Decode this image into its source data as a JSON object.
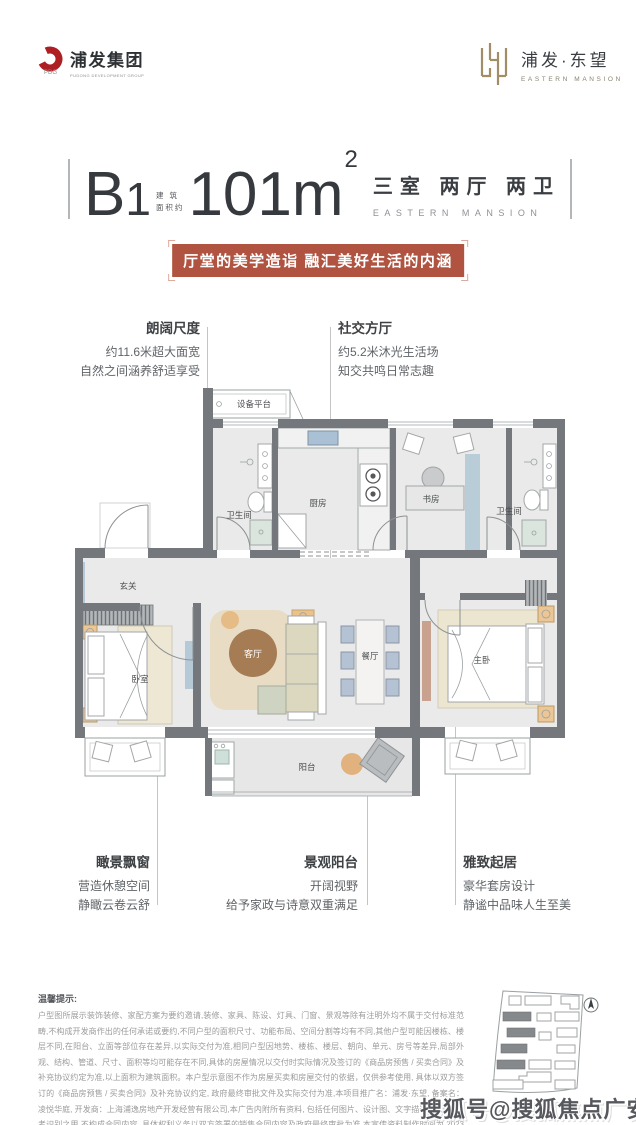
{
  "header": {
    "left_logo": {
      "name": "浦发集团",
      "subtitle": "PUDONG DEVELOPMENT GROUP"
    },
    "right_logo": {
      "name": "浦发·东望",
      "subtitle": "EASTERN MANSION"
    }
  },
  "title": {
    "unit_b": "B",
    "unit_1": "1",
    "area_note_line1": "建 筑",
    "area_note_line2": "面积约",
    "area": "101m",
    "area_sup": "2",
    "rooms": "三室 两厅 两卫",
    "rooms_sub": "EASTERN MANSION"
  },
  "banner": {
    "text": "厅堂的美学造诣 融汇美好生活的内涵"
  },
  "callouts": {
    "top_left": {
      "title": "朗阔尺度",
      "lines": [
        "约11.6米超大面宽",
        "自然之间涵养舒适享受"
      ]
    },
    "top_right": {
      "title": "社交方厅",
      "lines": [
        "约5.2米沐光生活场",
        "知交共鸣日常志趣"
      ]
    },
    "bottom_left": {
      "title": "瞰景飘窗",
      "lines": [
        "营造休憩空间",
        "静瞰云卷云舒"
      ]
    },
    "bottom_center": {
      "title": "景观阳台",
      "lines": [
        "开阔视野",
        "给予家政与诗意双重满足"
      ]
    },
    "bottom_right": {
      "title": "雅致起居",
      "lines": [
        "豪华套房设计",
        "静谧中品味人生至美"
      ]
    }
  },
  "floorplan": {
    "rooms": {
      "equipment": "设备平台",
      "bath1": "卫生间",
      "kitchen": "厨房",
      "study": "书房",
      "bath2": "卫生间",
      "foyer": "玄关",
      "bedroom": "卧室",
      "living": "客厅",
      "dining": "餐厅",
      "master": "主卧",
      "balcony": "阳台"
    }
  },
  "disclaimer": {
    "label": "温馨提示:",
    "text": "户型图所展示装饰装修、家配方案为要约邀请,装修、家具、陈设、灯具、门窗、景观等除有注明外均不属于交付标准范畴,不构成开发商作出的任何承诺或要约,不同户型的面积尺寸、功能布局、空间分割等均有不同,其他户型可能因楼栋、楼层不同,在阳台、立面等部位存在差异,以实际交付为准,相同户型因地势、楼栋、楼层、朝向、单元、房号等差异,局部外观、结构、管道、尺寸、面积等均可能存在不同,具体的房屋情况以交付时实际情况及签订的《商品房预售 / 买卖合同》及补充协议约定为准,以上面积为建筑面积。本户型示意图不作为房屋买卖和房屋交付的依据，仅供参考使用, 具体以双方签订的《商品房预售 / 买卖合同》及补充协议约定, 政府最终审批文件及实际交付为准,本项目推广名：浦发·东望, 备案名：凌悦华庭, 开发商：上海浦逸房地产开发经营有限公司,本广告内附所有资料, 包括任何图片、设计图、文字描述等, 仅供参考识别之用,不构成合同内容, 具体权利义务以双方签署的销售合同内容及政府最终审批为准,本宣传资料制作时间为 2023 年 08 月, 本公司保留对其进行变更或更改的权利, 如有更新, 恕不另行通知, 请以最终资料为准。"
  },
  "watermark": "搜狐号@搜狐焦点广安站",
  "colors": {
    "accent_red": "#b05340",
    "logo_red": "#ae1f24",
    "gold": "#a38d66",
    "wall_gray": "#74777b",
    "floor_gray": "#e9eae9",
    "glass_blue": "#b5c9d7",
    "rug_beige": "#e9dcc5",
    "table_brown": "#a57c54",
    "chair_blue": "#b5c2d4",
    "tan": "#e5bb84"
  }
}
